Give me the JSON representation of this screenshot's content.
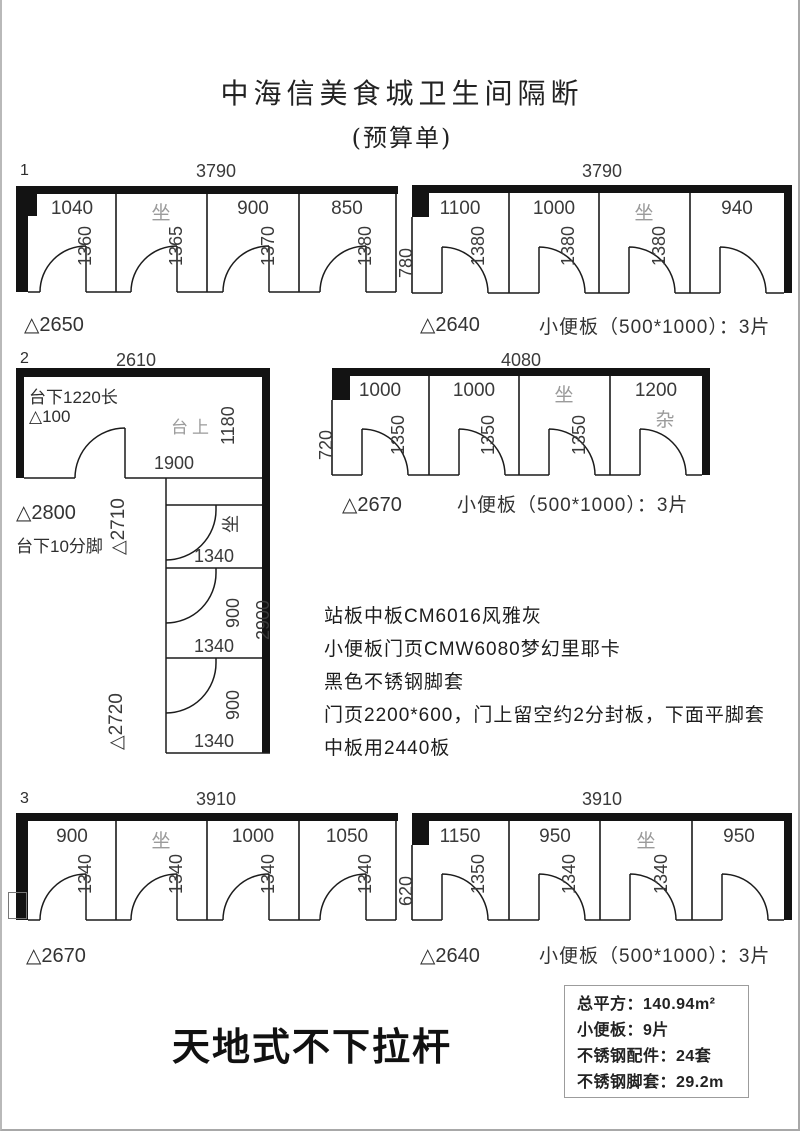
{
  "page": {
    "title": "中海信美食城卫生间隔断",
    "subtitle": "(预算单)",
    "footer_title": "天地式不下拉杆"
  },
  "d1": {
    "index": "1",
    "top_dim": "3790",
    "cells": [
      "1040",
      "坐",
      "900",
      "850"
    ],
    "depths": [
      "1360",
      "1365",
      "1370",
      "1380"
    ],
    "height_mark": "△2650"
  },
  "d4": {
    "top_dim": "3790",
    "entry_depth": "780",
    "cells": [
      "1100",
      "1000",
      "坐",
      "940"
    ],
    "depths": [
      "1380",
      "1380",
      "1380"
    ],
    "height_mark": "△2640",
    "urinal_note": "小便板（500*1000）：3片"
  },
  "d2": {
    "index": "2",
    "top_dim": "2610",
    "counter_note": "台下1220长",
    "counter_mark": "△100",
    "counter_top": "台上",
    "room_depth": "1180",
    "inner_dim": "1900",
    "entry_mark": "△2710",
    "seat": "坐",
    "height_mark": "△2800",
    "foot_note": "台下10分脚",
    "stall_mark": "△2720",
    "total_depth": "2900",
    "stall_widths": [
      "1340",
      "1340",
      "1340"
    ],
    "stall_depths": [
      "900",
      "900"
    ]
  },
  "d5": {
    "top_dim": "4080",
    "entry_depth": "720",
    "cells": [
      "1000",
      "1000",
      "坐",
      "1200"
    ],
    "misc": "杂",
    "depths": [
      "1350",
      "1350",
      "1350"
    ],
    "height_mark": "△2670",
    "urinal_note": "小便板（500*1000）：3片"
  },
  "d3": {
    "index": "3",
    "top_dim": "3910",
    "cells": [
      "900",
      "坐",
      "1000",
      "1050"
    ],
    "depths": [
      "1340",
      "1340",
      "1340",
      "1340"
    ],
    "height_mark": "△2670"
  },
  "d6": {
    "top_dim": "3910",
    "entry_depth": "620",
    "cells": [
      "1150",
      "950",
      "坐",
      "950"
    ],
    "depths": [
      "1350",
      "1340",
      "1340"
    ],
    "height_mark": "△2640",
    "urinal_note": "小便板（500*1000）：3片"
  },
  "specs": {
    "lines": [
      "站板中板CM6016风雅灰",
      "小便板门页CMW6080梦幻里耶卡",
      "黑色不锈钢脚套",
      "门页2200*600，门上留空约2分封板，下面平脚套",
      "中板用2440板"
    ]
  },
  "summary": {
    "lines": [
      "总平方：140.94m²",
      "小便板：9片",
      "不锈钢配件：24套",
      "不锈钢脚套：29.2m"
    ]
  }
}
